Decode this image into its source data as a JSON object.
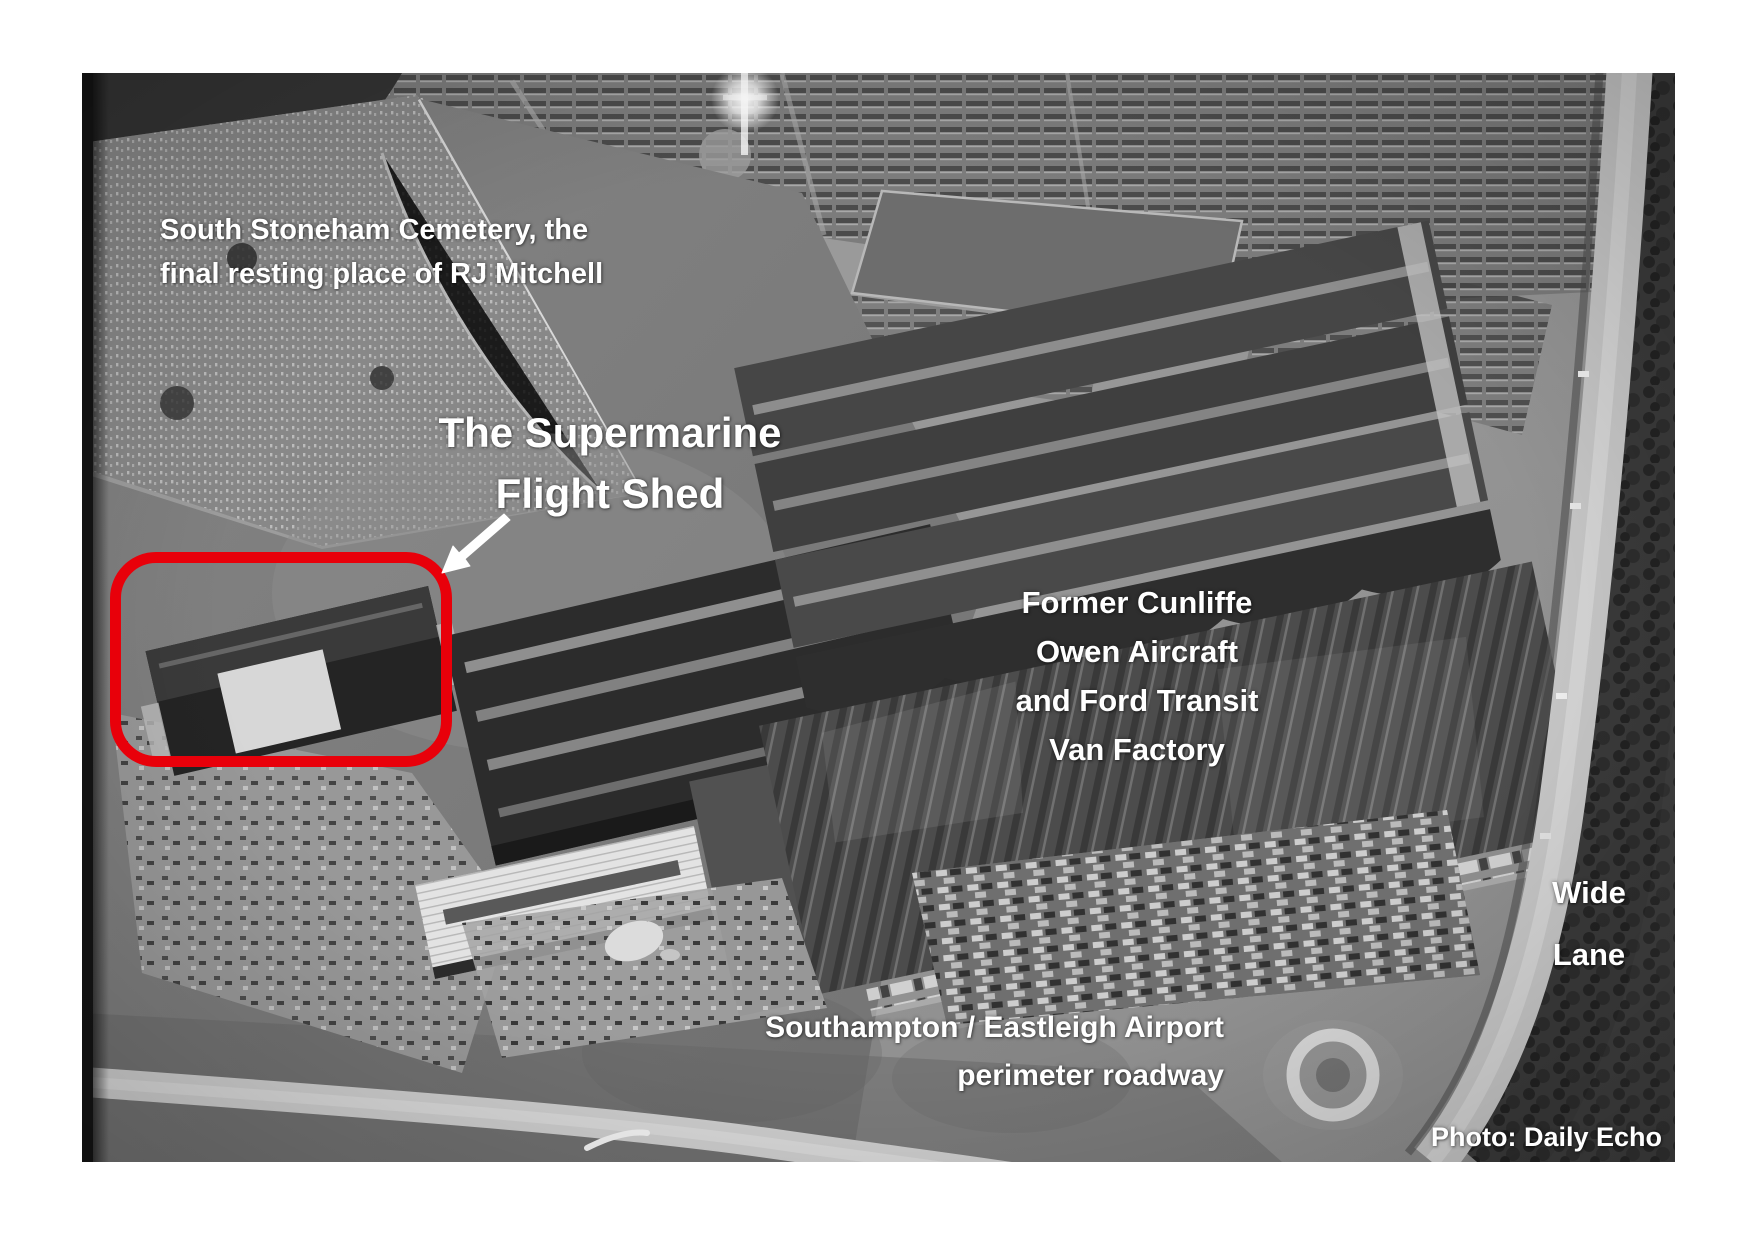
{
  "colors": {
    "page_bg": "#ffffff",
    "annotation_text": "#ffffff",
    "highlight_red": "#e8000a"
  },
  "photo": {
    "credit": "Photo: Daily Echo"
  },
  "annotations": {
    "cemetery": {
      "line1": "South Stoneham Cemetery, the",
      "line2": "final resting place of RJ Mitchell"
    },
    "flight_shed": {
      "line1": "The Supermarine",
      "line2": "Flight Shed"
    },
    "factory": {
      "line1": "Former Cunliffe",
      "line2": "Owen Aircraft",
      "line3": "and Ford Transit",
      "line4": "Van Factory"
    },
    "wide_lane": {
      "line1": "Wide",
      "line2": "Lane"
    },
    "perimeter_road": {
      "line1": "Southampton / Eastleigh Airport",
      "line2": "perimeter roadway"
    }
  }
}
